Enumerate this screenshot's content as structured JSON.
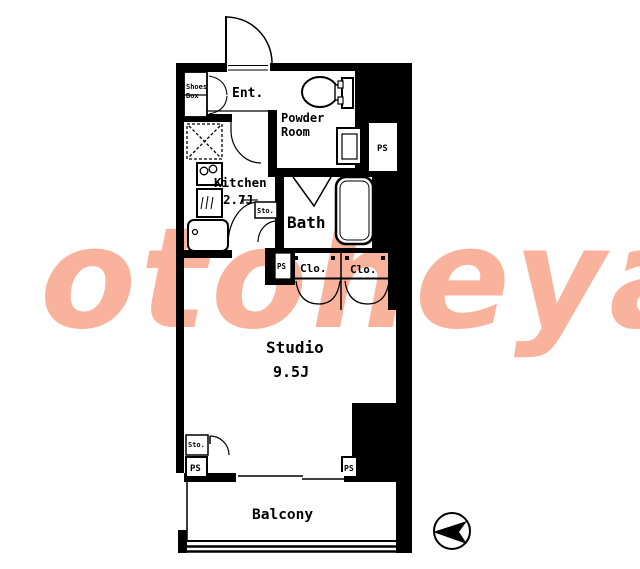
{
  "watermark": {
    "text": "otoheya",
    "color": "#f9b29c"
  },
  "colors": {
    "wall": "#000000",
    "background": "#ffffff",
    "watermark": "#f9b29c"
  },
  "rooms": {
    "entrance": {
      "label": "Ent."
    },
    "powder_room": {
      "label_line1": "Powder",
      "label_line2": "Room"
    },
    "kitchen": {
      "label": "Kitchen",
      "size": "2.7J"
    },
    "bath": {
      "label": "Bath"
    },
    "closet1": {
      "label": "Clo."
    },
    "closet2": {
      "label": "Clo."
    },
    "studio": {
      "label": "Studio",
      "size": "9.5J"
    },
    "balcony": {
      "label": "Balcony"
    },
    "shoes_box": {
      "label_line1": "Shoes",
      "label_line2": "Box"
    },
    "storage_hall": {
      "label": "Sto."
    },
    "storage_studio": {
      "label": "Sto."
    }
  },
  "pipe_spaces": {
    "top_right": "PS",
    "mid": "PS",
    "bottom_left": "PS",
    "bottom_right": "PS"
  }
}
